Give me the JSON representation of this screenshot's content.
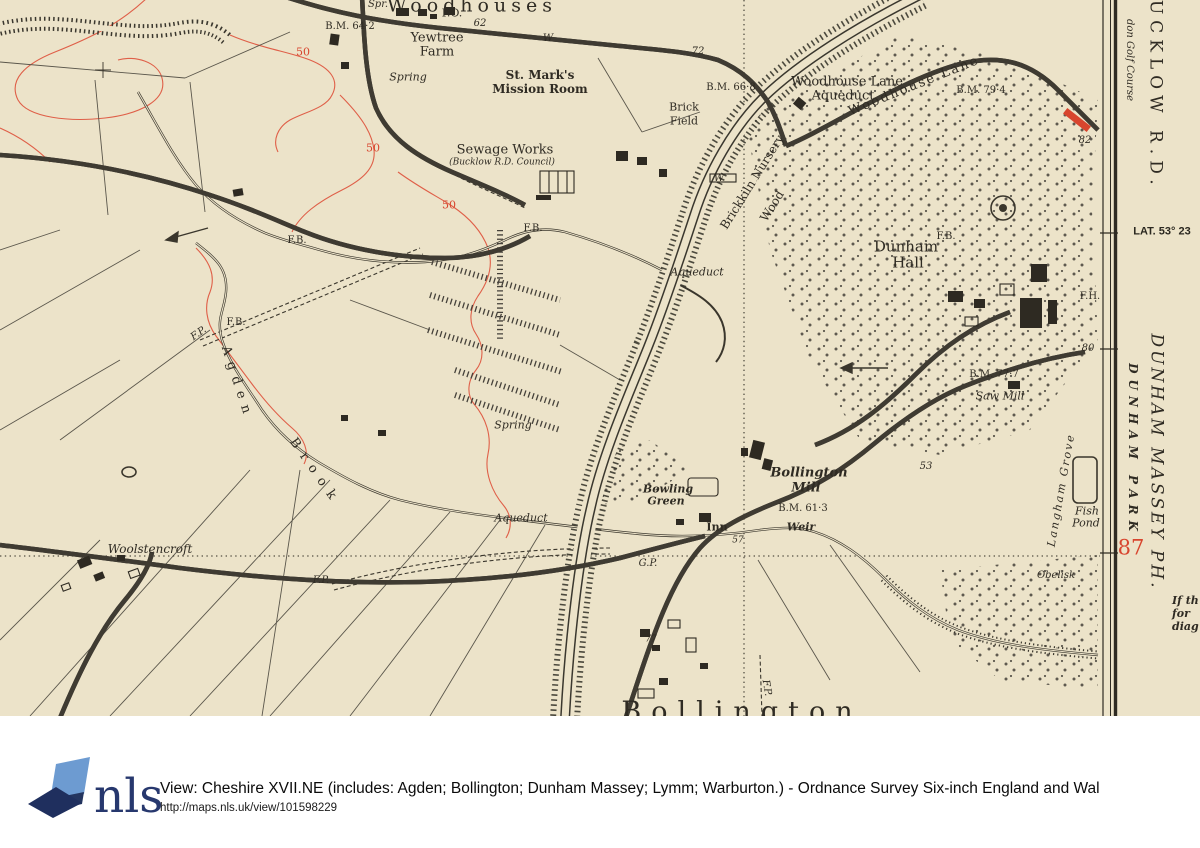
{
  "footer": {
    "caption": "View: Cheshire XVII.NE (includes: Agden; Bollington; Dunham Massey; Lymm; Warburton.) - Ordnance Survey Six-inch England and Wal",
    "url": "http://maps.nls.uk/view/101598229",
    "logo_text": "nls"
  },
  "colors": {
    "paper": "#ece3c9",
    "ink": "#3a362c",
    "contour_red": "#df5f48",
    "grid_red": "#d8452e",
    "logo_light_blue": "#6d9bd1",
    "logo_navy": "#1f2f5e"
  },
  "map": {
    "labels": [
      {
        "t": "Woodhouses",
        "x": 472,
        "y": 6,
        "fs": 19,
        "ls": 5
      },
      {
        "t": "Spr.",
        "x": 378,
        "y": 5,
        "fs": 10,
        "c": "i"
      },
      {
        "t": "P.O.",
        "x": 452,
        "y": 13,
        "fs": 11
      },
      {
        "t": "B.M. 64·2",
        "x": 350,
        "y": 27,
        "fs": 10
      },
      {
        "t": "62",
        "x": 480,
        "y": 24,
        "fs": 10,
        "c": "i"
      },
      {
        "t": "Yewtree",
        "x": 437,
        "y": 38,
        "fs": 13
      },
      {
        "t": "Farm",
        "x": 437,
        "y": 52,
        "fs": 13
      },
      {
        "t": "Spring",
        "x": 408,
        "y": 77,
        "fs": 11,
        "c": "i"
      },
      {
        "t": "W",
        "x": 548,
        "y": 39,
        "fs": 10,
        "c": "i"
      },
      {
        "t": "St. Mark's",
        "x": 540,
        "y": 75,
        "fs": 12,
        "c": "b"
      },
      {
        "t": "Mission Room",
        "x": 540,
        "y": 89,
        "fs": 12,
        "c": "b"
      },
      {
        "t": "72",
        "x": 698,
        "y": 52,
        "fs": 10,
        "c": "i"
      },
      {
        "t": "B.M. 66·8",
        "x": 731,
        "y": 88,
        "fs": 10
      },
      {
        "t": "Brick",
        "x": 684,
        "y": 107,
        "fs": 11
      },
      {
        "t": "Field",
        "x": 684,
        "y": 121,
        "fs": 11
      },
      {
        "t": "Woodhouse Lane",
        "x": 847,
        "y": 82,
        "fs": 13
      },
      {
        "t": "Aqueduct",
        "x": 843,
        "y": 96,
        "fs": 13
      },
      {
        "t": "Woodhouse Lane",
        "x": 914,
        "y": 86,
        "fs": 13,
        "r": -22,
        "ls": 2
      },
      {
        "t": "B.M. 79·4",
        "x": 981,
        "y": 91,
        "fs": 10
      },
      {
        "t": "82",
        "x": 1085,
        "y": 141,
        "fs": 10,
        "c": "i"
      },
      {
        "t": "W",
        "x": 719,
        "y": 179,
        "fs": 10,
        "c": "i"
      },
      {
        "t": "Brickkiln Nursery",
        "x": 752,
        "y": 182,
        "fs": 12,
        "r": -58
      },
      {
        "t": "Wood",
        "x": 772,
        "y": 206,
        "fs": 12,
        "r": -58
      },
      {
        "t": "Sewage Works",
        "x": 505,
        "y": 150,
        "fs": 13
      },
      {
        "t": "(Bucklow R.D. Council)",
        "x": 502,
        "y": 163,
        "fs": 9,
        "c": "i"
      },
      {
        "t": "F.B.",
        "x": 533,
        "y": 229,
        "fs": 10
      },
      {
        "t": "F.B.",
        "x": 297,
        "y": 241,
        "fs": 10
      },
      {
        "t": "F.B.",
        "x": 236,
        "y": 323,
        "fs": 10
      },
      {
        "t": "F.P.",
        "x": 199,
        "y": 334,
        "fs": 10,
        "r": -35,
        "c": "i"
      },
      {
        "t": "50",
        "x": 303,
        "y": 52,
        "fs": 11,
        "c": "rd"
      },
      {
        "t": "50",
        "x": 373,
        "y": 148,
        "fs": 11,
        "c": "rd"
      },
      {
        "t": "50",
        "x": 449,
        "y": 205,
        "fs": 11,
        "c": "rd"
      },
      {
        "t": "Aqueduct",
        "x": 697,
        "y": 272,
        "fs": 11,
        "c": "i"
      },
      {
        "t": "Dunham",
        "x": 906,
        "y": 247,
        "fs": 15
      },
      {
        "t": "Hall",
        "x": 908,
        "y": 263,
        "fs": 15
      },
      {
        "t": "F.B.",
        "x": 946,
        "y": 237,
        "fs": 10
      },
      {
        "t": "F.H.",
        "x": 1090,
        "y": 297,
        "fs": 10
      },
      {
        "t": "B.M. 77·7",
        "x": 994,
        "y": 375,
        "fs": 10
      },
      {
        "t": "Saw Mill",
        "x": 1000,
        "y": 396,
        "fs": 11,
        "c": "i"
      },
      {
        "t": "80",
        "x": 1088,
        "y": 349,
        "fs": 10,
        "c": "i"
      },
      {
        "t": "Agden",
        "x": 237,
        "y": 383,
        "fs": 13,
        "r": 72,
        "ls": 7
      },
      {
        "t": "Brook",
        "x": 315,
        "y": 472,
        "fs": 13,
        "r": 55,
        "ls": 8
      },
      {
        "t": "Spring",
        "x": 513,
        "y": 425,
        "fs": 11,
        "c": "i"
      },
      {
        "t": "Aqueduct",
        "x": 521,
        "y": 518,
        "fs": 11,
        "c": "i"
      },
      {
        "t": "Bowling",
        "x": 668,
        "y": 489,
        "fs": 11,
        "c": "i b"
      },
      {
        "t": "Green",
        "x": 666,
        "y": 501,
        "fs": 11,
        "c": "i b"
      },
      {
        "t": "Bollington",
        "x": 809,
        "y": 473,
        "fs": 13,
        "c": "i b"
      },
      {
        "t": "Mill",
        "x": 806,
        "y": 488,
        "fs": 13,
        "c": "i b"
      },
      {
        "t": "B.M. 61·3",
        "x": 803,
        "y": 509,
        "fs": 10
      },
      {
        "t": "Inn",
        "x": 717,
        "y": 527,
        "fs": 11,
        "c": "b"
      },
      {
        "t": "Weir",
        "x": 801,
        "y": 527,
        "fs": 11,
        "c": "i b"
      },
      {
        "t": "57",
        "x": 738,
        "y": 541,
        "fs": 9,
        "c": "i"
      },
      {
        "t": "G.P.",
        "x": 648,
        "y": 564,
        "fs": 10,
        "c": "i"
      },
      {
        "t": "53",
        "x": 926,
        "y": 467,
        "fs": 10,
        "c": "i"
      },
      {
        "t": "Langham Grove",
        "x": 1061,
        "y": 490,
        "fs": 11,
        "r": -80,
        "c": "i",
        "ls": 2
      },
      {
        "t": "Fish",
        "x": 1087,
        "y": 511,
        "fs": 11,
        "c": "i"
      },
      {
        "t": "Pond",
        "x": 1086,
        "y": 523,
        "fs": 11,
        "c": "i"
      },
      {
        "t": "Obelisk",
        "x": 1056,
        "y": 576,
        "fs": 10,
        "c": "i"
      },
      {
        "t": "Woolstencroft",
        "x": 150,
        "y": 549,
        "fs": 12,
        "c": "i"
      },
      {
        "t": "F.P.",
        "x": 321,
        "y": 581,
        "fs": 10,
        "c": "i"
      },
      {
        "t": "F.P.",
        "x": 766,
        "y": 688,
        "fs": 10,
        "r": 80,
        "c": "i"
      },
      {
        "t": "77",
        "x": 651,
        "y": 640,
        "fs": 9,
        "c": "i"
      },
      {
        "t": "Bollington",
        "x": 742,
        "y": 712,
        "fs": 27,
        "ls": 10
      },
      {
        "t": "BUCKLOW R.D.",
        "x": 1155,
        "y": 86,
        "fs": 17,
        "r": 90,
        "ls": 6
      },
      {
        "t": "don Golf Course",
        "x": 1129,
        "y": 60,
        "fs": 10,
        "r": 90,
        "c": "i"
      },
      {
        "t": "LAT. 53° 23",
        "x": 1162,
        "y": 232,
        "fs": 11,
        "c": "sans"
      },
      {
        "t": "DUNHAM MASSEY PH.",
        "x": 1156,
        "y": 462,
        "fs": 17,
        "r": 90,
        "c": "i",
        "ls": 3
      },
      {
        "t": "DUNHAM PARK",
        "x": 1133,
        "y": 450,
        "fs": 12,
        "r": 90,
        "c": "i b",
        "ls": 6
      },
      {
        "t": "87",
        "x": 1131,
        "y": 548,
        "fs": 21,
        "c": "rd"
      },
      {
        "t": "If th",
        "x": 1172,
        "y": 595,
        "fs": 11,
        "c": "i b",
        "al": 1
      },
      {
        "t": "for",
        "x": 1172,
        "y": 608,
        "fs": 11,
        "c": "i b",
        "al": 1
      },
      {
        "t": "diag",
        "x": 1172,
        "y": 621,
        "fs": 11,
        "c": "i b",
        "al": 1
      }
    ]
  }
}
